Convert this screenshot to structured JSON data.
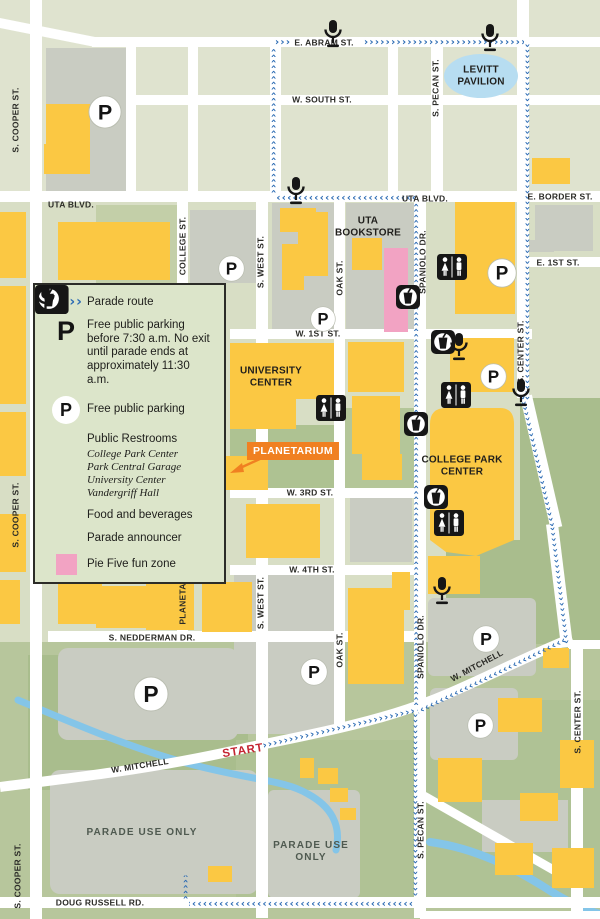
{
  "title": "Campus parade route map",
  "colors": {
    "route_blue": "#2d6cb4",
    "building_yellow": "#fbc843",
    "fun_zone_pink": "#f2a3c3",
    "planetarium_orange": "#f08021",
    "start_red": "#c42532",
    "levitt_blue": "#b7ddf1",
    "street_white": "#ffffff",
    "lot_gray": "#c9ccc2"
  },
  "legend": {
    "chevrons": "›››››",
    "p_glyph": "P",
    "items": [
      {
        "label": "Parade route"
      },
      {
        "label": "Free public parking before 7:30 a.m. No exit until parade ends at approximately 11:30 a.m."
      },
      {
        "label": "Free public parking"
      },
      {
        "label": "Public Restrooms",
        "sublabels": [
          "College Park Center",
          "Park Central Garage",
          "University Center",
          "Vandergriff Hall"
        ]
      },
      {
        "label": "Food and beverages"
      },
      {
        "label": "Parade announcer"
      },
      {
        "label": "Pie Five fun zone"
      }
    ]
  },
  "map": {
    "route": {
      "chevron_char": "›",
      "color": "#2d6cb4",
      "segments": [
        [
          275,
          120,
          146,
          -90
        ],
        [
          283,
          43,
          16,
          0
        ],
        [
          444,
          43,
          160,
          0
        ],
        [
          526,
          222,
          358,
          90
        ],
        [
          536,
          461,
          134,
          77
        ],
        [
          558,
          585,
          118,
          83
        ],
        [
          491,
          674,
          164,
          154
        ],
        [
          417,
          453,
          505,
          -90
        ],
        [
          346,
          196,
          140,
          180
        ],
        [
          339,
          729,
          157,
          -13
        ],
        [
          414,
          804,
          182,
          90
        ],
        [
          301,
          902,
          224,
          180
        ],
        [
          187,
          887,
          24,
          -90
        ]
      ]
    },
    "street_labels": [
      [
        "E. ABRAM ST.",
        324,
        43,
        0
      ],
      [
        "W. SOUTH ST.",
        322,
        100,
        0
      ],
      [
        "UTA BLVD.",
        71,
        205,
        0
      ],
      [
        "UTA BLVD.",
        425,
        199,
        0
      ],
      [
        "E. BORDER ST.",
        560,
        197,
        0
      ],
      [
        "E. 1ST ST.",
        558,
        263,
        0
      ],
      [
        "W. 1ST ST.",
        318,
        334,
        0
      ],
      [
        "W. 3RD ST.",
        310,
        493,
        0
      ],
      [
        "W. 4TH ST.",
        312,
        570,
        0
      ],
      [
        "S. NEDDERMAN DR.",
        152,
        638,
        0
      ],
      [
        "W. MITCHELL",
        140,
        766,
        -9
      ],
      [
        "W. MITCHELL",
        477,
        666,
        -28
      ],
      [
        "DOUG RUSSELL RD.",
        100,
        903,
        0
      ],
      [
        "S. COOPER ST.",
        16,
        120,
        -90
      ],
      [
        "S. COOPER ST.",
        16,
        515,
        -90
      ],
      [
        "S. COOPER ST.",
        18,
        876,
        -90
      ],
      [
        "COLLEGE ST.",
        183,
        246,
        -90
      ],
      [
        "S. WEST ST.",
        261,
        262,
        -90
      ],
      [
        "S. WEST ST.",
        261,
        603,
        -90
      ],
      [
        "OAK ST.",
        340,
        278,
        -90
      ],
      [
        "OAK ST.",
        340,
        650,
        -90
      ],
      [
        "SPANIOLO DR.",
        423,
        262,
        -90
      ],
      [
        "SPANIOLO DR.",
        421,
        647,
        -90
      ],
      [
        "S. PECAN ST.",
        436,
        88,
        -90
      ],
      [
        "S. PECAN ST.",
        421,
        830,
        -90
      ],
      [
        "S. CENTER ST.",
        521,
        352,
        -90
      ],
      [
        "S. CENTER ST.",
        578,
        722,
        -90
      ],
      [
        "PLANETA",
        183,
        604,
        -90
      ]
    ],
    "place_labels": [
      {
        "text": "LEVITT\nPAVILION",
        "x": 481,
        "y": 76,
        "kind": "building"
      },
      {
        "text": "UTA\nBOOKSTORE",
        "x": 368,
        "y": 227,
        "kind": "building"
      },
      {
        "text": "UNIVERSITY\nCENTER",
        "x": 271,
        "y": 377,
        "kind": "building"
      },
      {
        "text": "COLLEGE PARK\nCENTER",
        "x": 462,
        "y": 466,
        "kind": "building"
      },
      {
        "text": "PLANETARIUM",
        "x": 293,
        "y": 451,
        "kind": "badge"
      },
      {
        "text": "START",
        "x": 243,
        "y": 751,
        "kind": "start"
      },
      {
        "text": "PARADE USE ONLY",
        "x": 142,
        "y": 833,
        "kind": "lot"
      },
      {
        "text": "PARADE USE\nONLY",
        "x": 311,
        "y": 852,
        "kind": "lot"
      }
    ],
    "icons": [
      [
        "parking",
        88,
        95,
        34
      ],
      [
        "parking",
        218,
        255,
        27
      ],
      [
        "parking",
        310,
        306,
        26
      ],
      [
        "parking",
        487,
        258,
        30
      ],
      [
        "parking",
        480,
        363,
        27
      ],
      [
        "parking",
        133,
        676,
        36
      ],
      [
        "parking",
        300,
        658,
        28
      ],
      [
        "parking",
        472,
        625,
        28
      ],
      [
        "parking",
        467,
        712,
        27
      ],
      [
        "restroom",
        437,
        254,
        1
      ],
      [
        "restroom",
        441,
        382,
        1
      ],
      [
        "restroom",
        316,
        395,
        1
      ],
      [
        "restroom",
        434,
        510,
        1
      ],
      [
        "food",
        396,
        285,
        1
      ],
      [
        "food",
        431,
        330,
        1
      ],
      [
        "food",
        404,
        412,
        1
      ],
      [
        "food",
        424,
        485,
        1
      ],
      [
        "announcer",
        323,
        20,
        1
      ],
      [
        "announcer",
        480,
        24,
        1
      ],
      [
        "announcer",
        286,
        177,
        1
      ],
      [
        "announcer",
        449,
        333,
        1
      ],
      [
        "announcer",
        511,
        379,
        1
      ],
      [
        "announcer",
        432,
        577,
        1
      ]
    ]
  }
}
